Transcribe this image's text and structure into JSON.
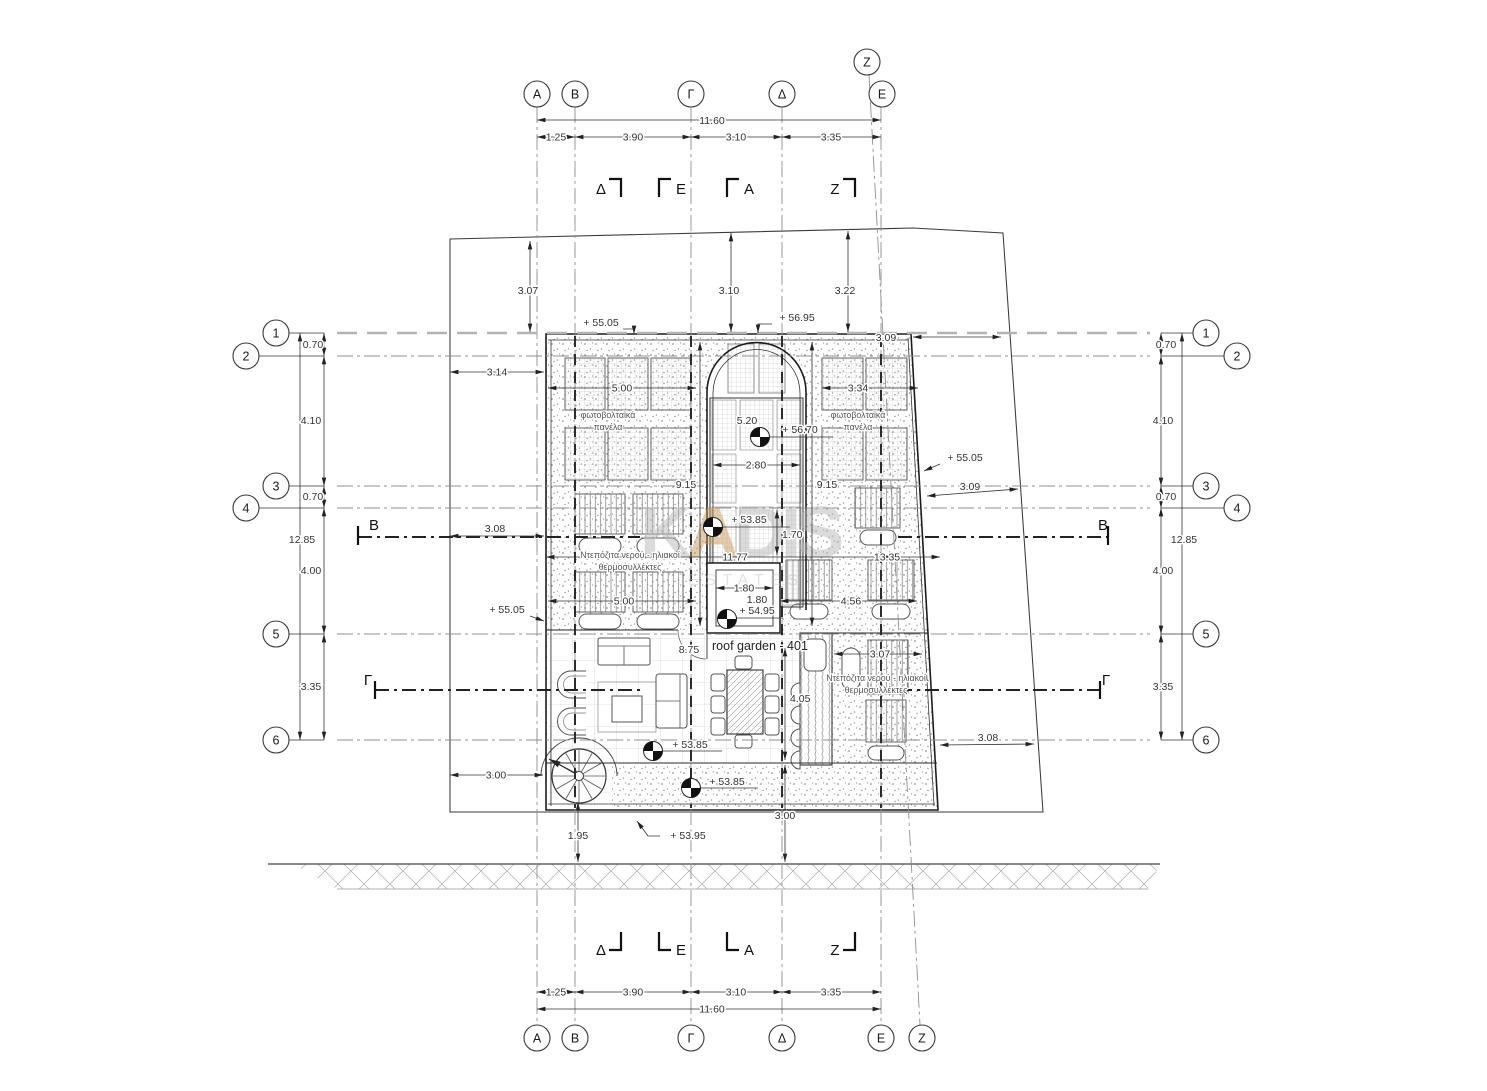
{
  "drawing": {
    "type": "roof plan",
    "room_label": "roof garden - 401"
  },
  "watermark": {
    "part1": "K",
    "part2": "A",
    "part3": "DIS",
    "subtitle": "ESTATES",
    "gray": "#b9b9b9",
    "tan": "#c79a5e"
  },
  "axes": {
    "cols": [
      "Α",
      "Β",
      "Γ",
      "Δ",
      "Ε",
      "Ζ"
    ],
    "rows": [
      "1",
      "2",
      "3",
      "4",
      "5",
      "6"
    ]
  },
  "labels": {
    "pv_line1": "φωτοβολταϊκά",
    "pv_line2": "πανέλα",
    "tanks_line1": "Ντεπόζιτα νερού - ηλιακοί",
    "tanks_line2": "θερμοσυλλέκτες",
    "room": "roof garden - 401"
  },
  "dims": {
    "h_total": "11.60",
    "h_segs": [
      "1.25",
      "3.90",
      "3.10",
      "3.35"
    ],
    "v_total": "12.85",
    "v_segs": [
      "0.70",
      "4.10",
      "0.70",
      "4.00",
      "3.35"
    ],
    "site_top": [
      "3.07",
      "3.10",
      "3.22"
    ],
    "left_off": [
      "3.14",
      "3.08",
      "3.00"
    ],
    "right_off": [
      "3.09",
      "3.09"
    ],
    "pv_left": "5.00",
    "pv_right": "3.34",
    "arch_height": "5.20",
    "arch_width": "2.80",
    "side_l": "9.15",
    "side_r": "9.15",
    "riser": "1.70",
    "run1": "11.77",
    "run2": "13.35",
    "coll_left": "5.00",
    "coll_right": "4.56",
    "shaft_w": "1.80",
    "shaft_h": "1.80",
    "garden_w": "8.75",
    "garden_h": "4.05",
    "planter_off": "3.07",
    "right_low": "3.08",
    "bottom_v": "3.00",
    "stair_off": "1.95"
  },
  "levels": {
    "l5505": "+ 55.05",
    "l5695": "+ 56.95",
    "l5670": "+ 56.70",
    "l5385": "+ 53.85",
    "l5495": "+ 54.95",
    "l5395": "+ 53.95"
  }
}
